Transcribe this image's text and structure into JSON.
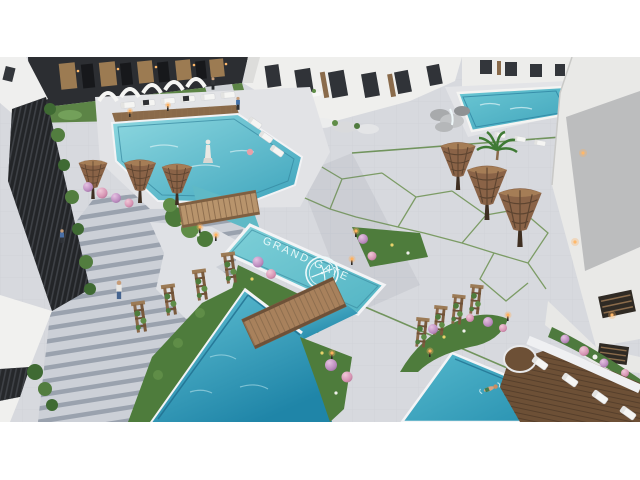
{
  "scene": {
    "pool_label": "GRAND GATE",
    "description": "aerial 3D architectural render of a residential resort courtyard with pools",
    "objects": [
      "upper-left lagoon pool with loungers and white shade arches",
      "central pool with GRAND GATE floor lettering and ring emblem",
      "lower zigzag pool crossed by wooden bridge",
      "lower-right pool with swimmer and wooden lounger deck",
      "upper-right pool with rock waterfall and palm",
      "wide staircase with pedestrians",
      "wicker supertree sculptures",
      "wooden trellis planter towers",
      "purple flower bushes",
      "white apartment buildings and dark ground-floor facade"
    ],
    "icons": {
      "logo": "double-ring-emblem"
    },
    "palette": {
      "water_light": "#8ed8e0",
      "water_mid": "#52b4c4",
      "water_deep": "#1f85a8",
      "pool_tile_line": "#1f6e8e",
      "pavement": "#d7d9de",
      "deck_white": "#e2e3e6",
      "stair_tread": "#9aa2ae",
      "building_white": "#efefed",
      "facade_dark": "#2c2e32",
      "door_wood": "#9c7b52",
      "bridge_wood": "#b8946c",
      "deck_wood_dark": "#6d5036",
      "supertree_wicker": "#8a6347",
      "grass": "#4f7b3d",
      "flower_purple": "#bd8ec0",
      "flower_pink": "#d795b4",
      "lamp_glow": "#ffb15e",
      "slat_fence": "#232528"
    }
  }
}
